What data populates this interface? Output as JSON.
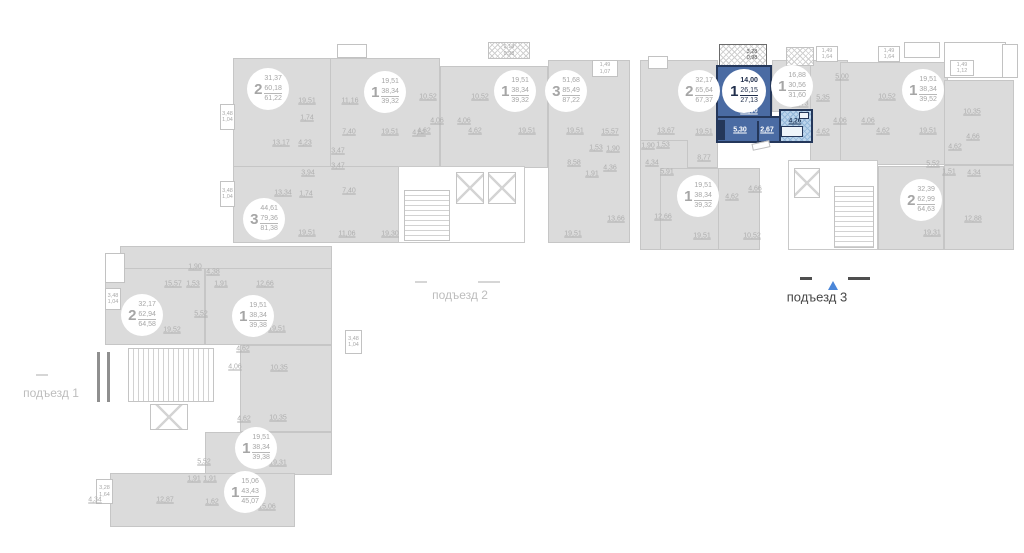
{
  "palette": {
    "background": "#ffffff",
    "apartment_fill": "#dbdbdb",
    "apartment_wall": "#c6c6c6",
    "label_gray": "#aeaeae",
    "highlight_fill": "#4a6ba3",
    "highlight_wall": "#24375a",
    "highlight_bath": "#bdd5ec",
    "highlight_text": "#ffffff",
    "entrance_active_text": "#474747",
    "arrow_blue": "#4a86d8"
  },
  "entrances": {
    "e1": {
      "label": "подъезд 1"
    },
    "e2": {
      "label": "подъезд 2"
    },
    "e3": {
      "label": "подъезд 3"
    }
  },
  "highlight": {
    "rooms": "1",
    "living_area": "14,00",
    "area": "26,15",
    "total_area": "27,13",
    "room_main": "14,00",
    "room_hall": "5,30",
    "room_corridor": "2,67",
    "room_bath": "4,26",
    "balcony": "3,28\n0,98"
  },
  "apartments": {
    "p2a1": {
      "rooms": "2",
      "v1": "31,37",
      "v2": "60,18",
      "v3": "61,22"
    },
    "p2a2": {
      "rooms": "1",
      "v1": "19,51",
      "v2": "38,34",
      "v3": "39,32"
    },
    "p2a3": {
      "rooms": "1",
      "v1": "19,51",
      "v2": "38,34",
      "v3": "39,32"
    },
    "p2a4": {
      "rooms": "3",
      "v1": "51,68",
      "v2": "85,49",
      "v3": "87,22"
    },
    "p2a5": {
      "rooms": "3",
      "v1": "44,61",
      "v2": "79,36",
      "v3": "81,38"
    },
    "p3a1": {
      "rooms": "2",
      "v1": "32,17",
      "v2": "65,64",
      "v3": "67,37"
    },
    "p3a2": {
      "rooms": "1",
      "v1": "16,88",
      "v2": "30,56",
      "v3": "31,60"
    },
    "p3a3": {
      "rooms": "1",
      "v1": "19,51",
      "v2": "38,34",
      "v3": "39,52"
    },
    "p3a4": {
      "rooms": "1",
      "v1": "19,51",
      "v2": "38,34",
      "v3": "39,32"
    },
    "p3a5": {
      "rooms": "2",
      "v1": "32,39",
      "v2": "62,99",
      "v3": "64,63"
    },
    "p1a1": {
      "rooms": "2",
      "v1": "32,17",
      "v2": "62,94",
      "v3": "64,58"
    },
    "p1a2": {
      "rooms": "1",
      "v1": "19,51",
      "v2": "38,34",
      "v3": "39,38"
    },
    "p1a3": {
      "rooms": "1",
      "v1": "19,51",
      "v2": "38,34",
      "v3": "39,38"
    },
    "p1a4": {
      "rooms": "1",
      "v1": "15,06",
      "v2": "43,43",
      "v3": "45,07"
    },
    "hl": {
      "rooms": "1",
      "v1": "14,00",
      "v2": "26,15",
      "v3": "27,13"
    }
  },
  "labels": [
    "19,51",
    "11,16",
    "1,74",
    "13,17",
    "4,23",
    "7,40",
    "19,51",
    "4,62",
    "3,47",
    "3,47",
    "3,94",
    "13,34",
    "1,74",
    "7,40",
    "19,51",
    "11,06",
    "19,30",
    "10,52",
    "10,52",
    "4,06",
    "4,06",
    "4,62",
    "4,62",
    "19,51",
    "19,51",
    "15,57",
    "1,53",
    "1,90",
    "4,36",
    "8,58",
    "1,91",
    "13,66",
    "19,51",
    "13,67",
    "19,51",
    "1,90",
    "1,53",
    "4,34",
    "5,91",
    "8,77",
    "12,66",
    "11,73",
    "5,00",
    "5,35",
    "10,52",
    "4,06",
    "4,06",
    "4,62",
    "4,62",
    "19,51",
    "10,35",
    "4,66",
    "4,62",
    "5,52",
    "1,51",
    "4,34",
    "12,88",
    "19,31",
    "4,62",
    "4,66",
    "19,51",
    "10,52",
    "15,57",
    "1,53",
    "1,91",
    "12,66",
    "1,90",
    "4,38",
    "5,52",
    "19,52",
    "19,51",
    "4,62",
    "10,35",
    "4,06",
    "4,62",
    "10,35",
    "5,52",
    "19,31",
    "1,91",
    "1,91",
    "4,34",
    "12,87",
    "1,62",
    "15,06"
  ],
  "chips": [
    "3,48\n1,04",
    "3,48\n1,04",
    "2,18\n0,98",
    "1,49\n1,07",
    "1,49\n1,64",
    "1,49\n1,64",
    "1,49\n1,12",
    "3,48\n1,04",
    "3,28\n1,64",
    "3,48\n1,04"
  ]
}
